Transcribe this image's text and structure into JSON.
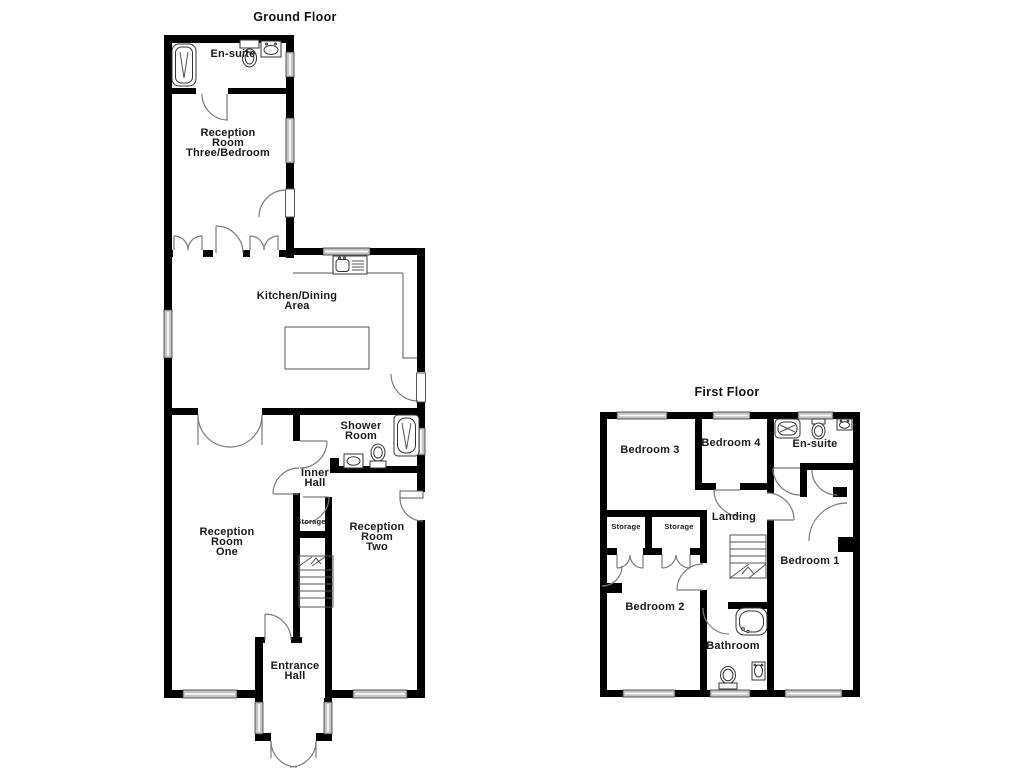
{
  "ground_floor": {
    "title": "Ground Floor",
    "rooms": {
      "ensuite": "En-suite",
      "reception_three": "Reception\nRoom\nThree/Bedroom",
      "kitchen": "Kitchen/Dining\nArea",
      "shower_room": "Shower\nRoom",
      "inner_hall": "Inner\nHall",
      "storage": "Storage",
      "reception_one": "Reception\nRoom\nOne",
      "reception_two": "Reception\nRoom\nTwo",
      "entrance_hall": "Entrance\nHall"
    }
  },
  "first_floor": {
    "title": "First Floor",
    "rooms": {
      "bedroom_3": "Bedroom 3",
      "bedroom_4": "Bedroom 4",
      "ensuite": "En-suite",
      "landing": "Landing",
      "storage_left": "Storage",
      "storage_right": "Storage",
      "bedroom_2": "Bedroom 2",
      "bathroom": "Bathroom",
      "bedroom_1": "Bedroom 1"
    }
  },
  "colors": {
    "wall": "#000000",
    "door_arc": "#7a7a7a",
    "window_fill": "#c4c4c4",
    "fixture_stroke": "#333333",
    "text": "#1a1a1a",
    "background": "#ffffff"
  }
}
